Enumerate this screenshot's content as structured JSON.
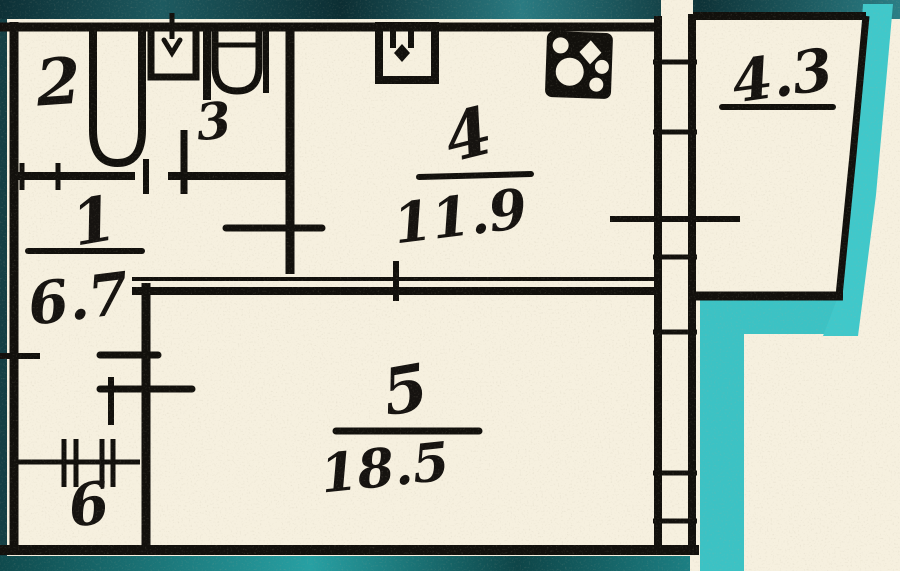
{
  "document": {
    "type": "scanned apartment floor plan",
    "units_note": "room areas in square meters"
  },
  "rooms": {
    "bathroom": {
      "number": "2"
    },
    "toilet": {
      "number": "3"
    },
    "hallway": {
      "number": "1",
      "area": "6.7"
    },
    "kitchen": {
      "number": "4",
      "area": "11.9"
    },
    "living_room": {
      "number": "5",
      "area": "18.5"
    },
    "storage": {
      "number": "6"
    },
    "balcony": {
      "area": "4.3"
    }
  },
  "fixtures": {
    "bathtub": "bathtub",
    "wash_basin": "wash basin",
    "toilet_bowl": "toilet bowl",
    "kitchen_sink": "kitchen sink",
    "stove": "stove"
  },
  "colors": {
    "paper": "#f6f0df",
    "wall": "#12100c",
    "teal_bright": "#3cc2c4",
    "teal_dark": "#14464b"
  }
}
